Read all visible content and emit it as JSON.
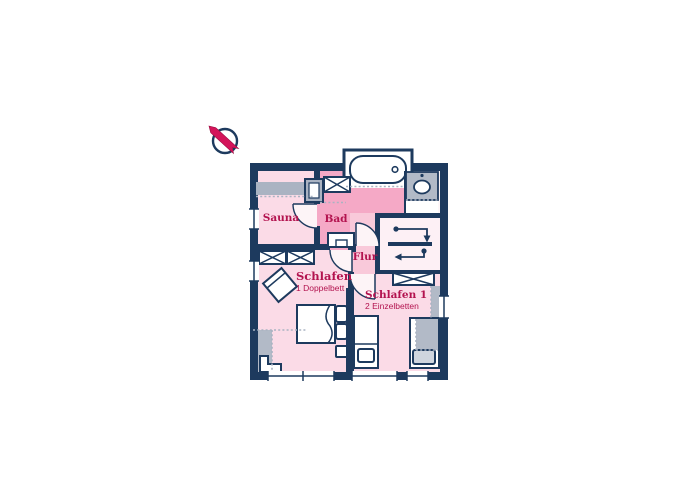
{
  "plan": {
    "title": "apartment-floor-plan",
    "rooms": [
      {
        "id": "sauna",
        "label": "Sauna",
        "sublabel": ""
      },
      {
        "id": "bad",
        "label": "Bad",
        "sublabel": ""
      },
      {
        "id": "flur",
        "label": "Flur",
        "sublabel": ""
      },
      {
        "id": "schlafen",
        "label": "Schlafen",
        "sublabel": "1 Doppelbett"
      },
      {
        "id": "schlafen1",
        "label": "Schlafen 1",
        "sublabel": "2 Einzelbetten"
      }
    ],
    "fixtures": [
      "compass-icon",
      "bathtub",
      "toilet",
      "washbasin",
      "sauna-bench",
      "wardrobe-x-box",
      "double-bed",
      "single-bed",
      "armchair",
      "stair-direction-arrows",
      "window",
      "door-swing"
    ],
    "colors": {
      "wall": "#1d3a5e",
      "room_pink": "#fbdbe7",
      "bad_pink": "#f5a9c6",
      "flur_pink": "#f9c9da",
      "stairs_pink": "#fdf0f5",
      "slope_gray": "#b2bac7",
      "label_crimson": "#b3134f",
      "needle_pink": "#d4145a"
    }
  }
}
